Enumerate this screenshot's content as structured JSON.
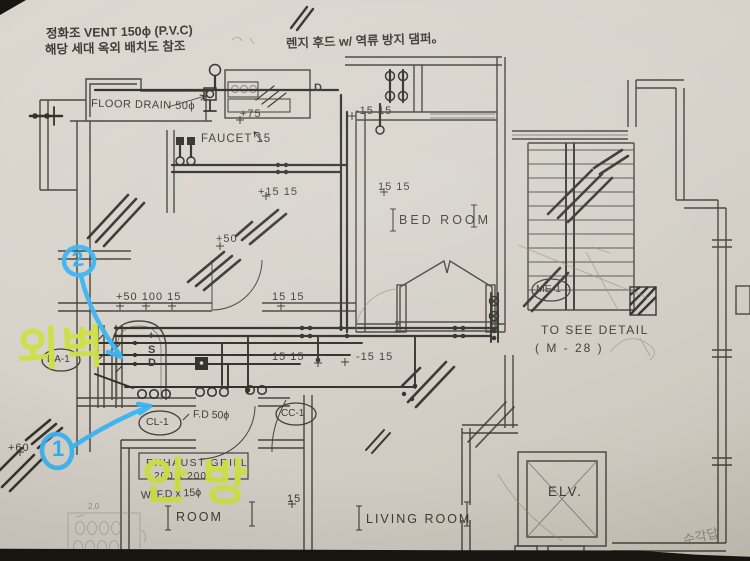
{
  "palette": {
    "paper": "#d7d3cb",
    "ink": "#3d3a33",
    "pipe": "#2f2d28",
    "pencil": "#8b8578",
    "marker_blue": "#39b4f3",
    "highlighter": "#cce042",
    "photo_edge": "#17150f"
  },
  "notes": {
    "septic_line1": "정화조 VENT 150ϕ (P.V.C)",
    "septic_line2": "해당 세대  옥외 배치도 참조",
    "range_hood": "렌지 후드 w/ 역류 방지 댐퍼。",
    "pencil_corner": "수각답",
    "pencil_sketch_dim": "2.0"
  },
  "rooms": {
    "bed_room": "BED ROOM",
    "living_room": "LIVING ROOM",
    "room": "ROOM",
    "elevator": "ELV."
  },
  "fixtures": {
    "floor_drain": "FLOOR DRAIN 50ϕ",
    "faucet": "FAUCET 15",
    "fd50": "F.D 50ϕ",
    "exhaust_line1": "EXHAUST GRILL",
    "exhaust_line2": "200 x 200",
    "exhaust_line3": "W/ F.D x 15ϕ",
    "pipe_plus": "+",
    "pipe_s": "S",
    "pipe_d": "D",
    "kitchen_d": "D"
  },
  "tags": {
    "da1": "DA-1",
    "cl1": "CL-1",
    "cc1": "CC-1",
    "me1": "ME-1"
  },
  "detail_note": {
    "line1": "TO SEE  DETAIL",
    "line2": "( M - 28 )"
  },
  "dimensions": {
    "d75": "+75",
    "d15a": "-15 15",
    "d15b": "+15 15",
    "d15c": "15 15",
    "d50": "+50",
    "d50_100": "+50 100 15",
    "d15d": "15 15",
    "d15e": "15 15",
    "d15f": "-15 15",
    "d15g": "15",
    "d60": "+60"
  },
  "annotations": {
    "circle1": "1",
    "circle2": "2",
    "exterior_wall": "외벽",
    "master_room": "안방"
  }
}
